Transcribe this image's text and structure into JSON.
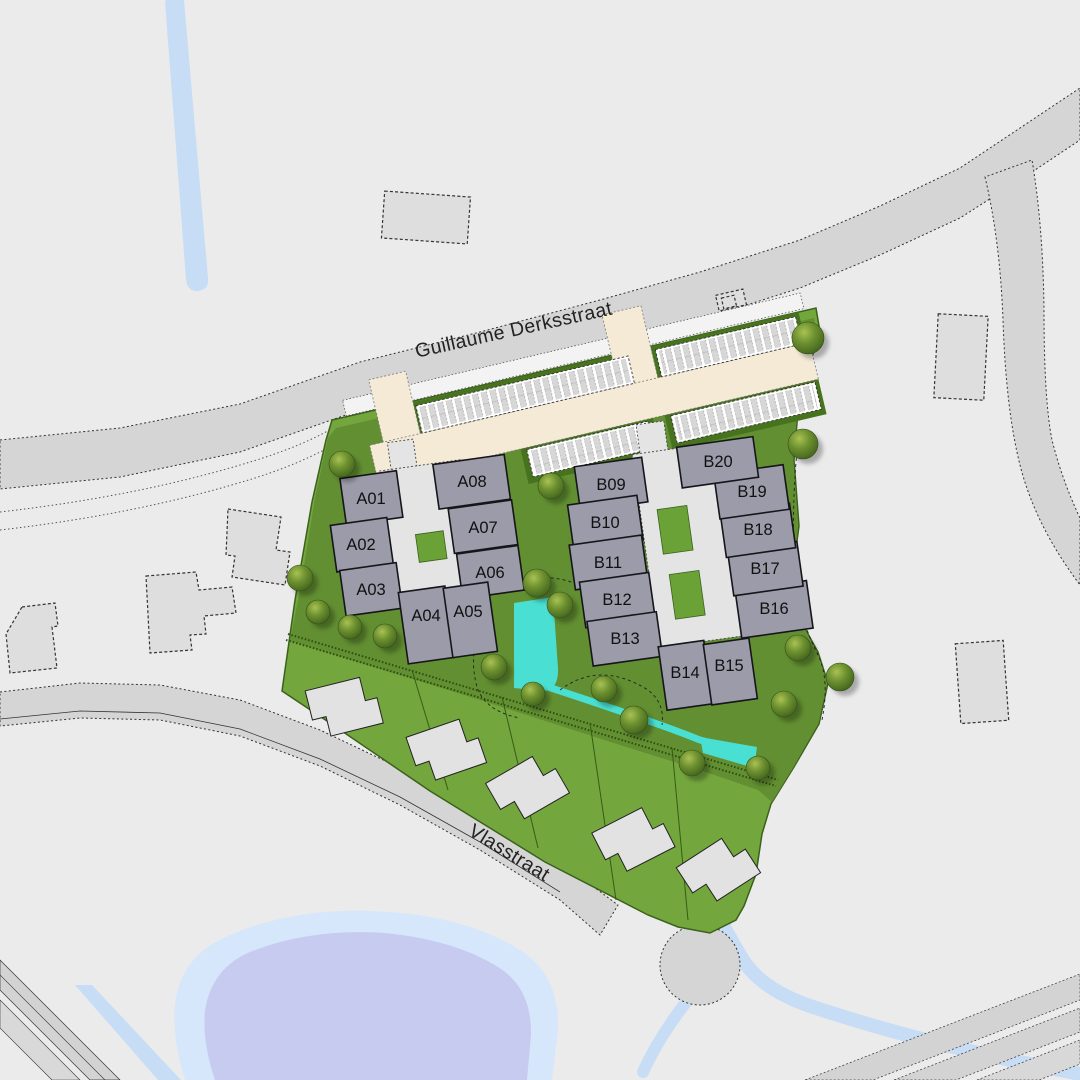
{
  "map_title": "housing development site plan",
  "streets": [
    {
      "name": "Guillaume Derksstraat"
    },
    {
      "name": "Vlasstraat"
    }
  ],
  "clusters": [
    {
      "id": "A",
      "units": [
        {
          "label": "A01"
        },
        {
          "label": "A02"
        },
        {
          "label": "A03"
        },
        {
          "label": "A04"
        },
        {
          "label": "A05"
        },
        {
          "label": "A06"
        },
        {
          "label": "A07"
        },
        {
          "label": "A08"
        }
      ]
    },
    {
      "id": "B",
      "units": [
        {
          "label": "B09"
        },
        {
          "label": "B10"
        },
        {
          "label": "B11"
        },
        {
          "label": "B12"
        },
        {
          "label": "B13"
        },
        {
          "label": "B14"
        },
        {
          "label": "B15"
        },
        {
          "label": "B16"
        },
        {
          "label": "B17"
        },
        {
          "label": "B18"
        },
        {
          "label": "B19"
        },
        {
          "label": "B20"
        }
      ]
    }
  ],
  "detached_house_plots": 5,
  "colors": {
    "background": "#ebebeb",
    "road_gray": "#d5d5d5",
    "access_road_cream": "#f5ead6",
    "site_green": "#74a63e",
    "communal_green": "#628f31",
    "building_gray": "#9b9ba9",
    "courtyard_gray": "#e4e4e4",
    "water_cyan": "#49dfd2",
    "pond_inner": "#c7cbf0",
    "pond_outer": "#d7e7fb",
    "stream_blue": "#c7ddf6"
  }
}
